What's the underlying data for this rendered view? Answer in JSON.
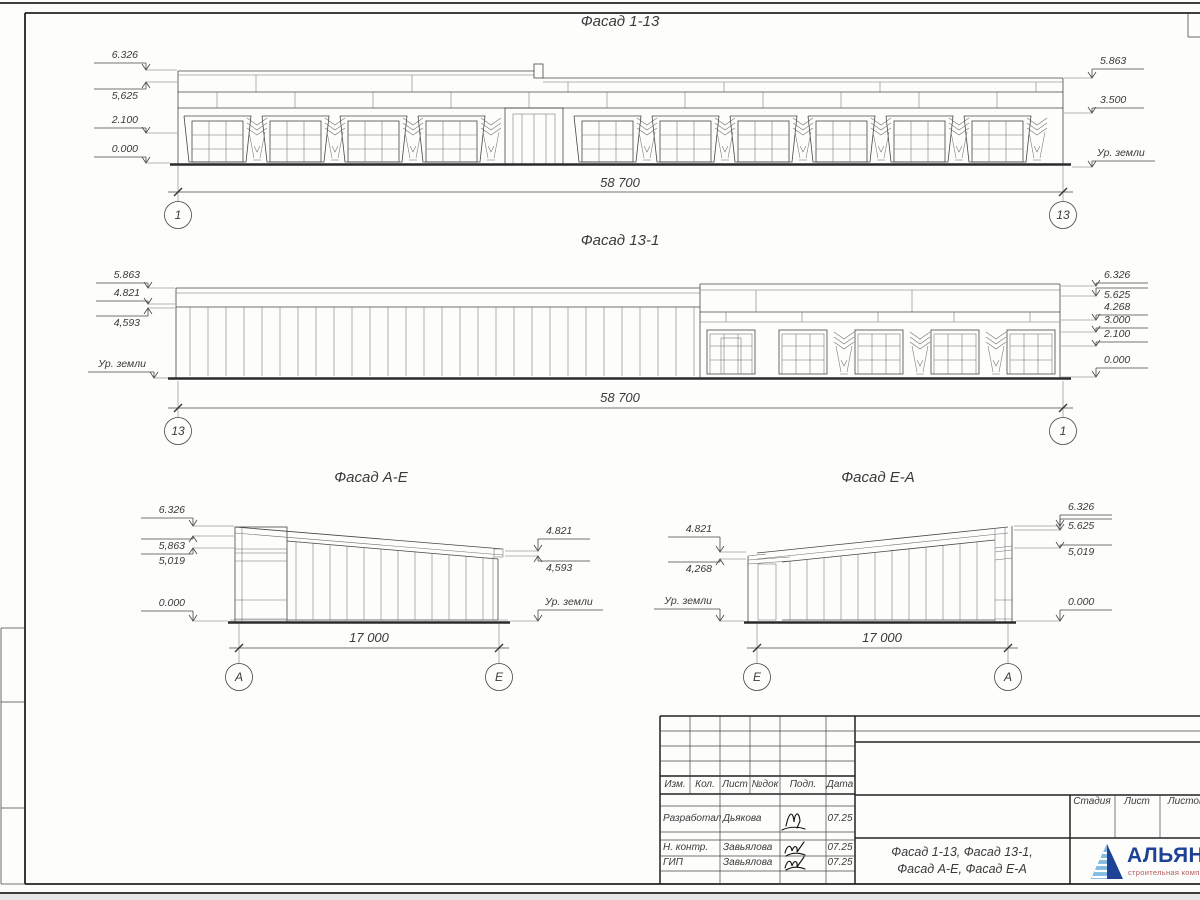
{
  "elevations": {
    "f113": {
      "title": "Фасад 1-13",
      "dim": "58 700",
      "axis_left": "1",
      "axis_right": "13",
      "levels_left": [
        "6.326",
        "5,625",
        "2.100",
        "0.000"
      ],
      "levels_right": [
        "5.863",
        "3.500",
        "Ур. земли"
      ]
    },
    "f131": {
      "title": "Фасад 13-1",
      "dim": "58 700",
      "axis_left": "13",
      "axis_right": "1",
      "levels_left": [
        "5.863",
        "4.821",
        "4,593",
        "Ур. земли"
      ],
      "levels_right": [
        "6.326",
        "5.625",
        "4.268",
        "3.000",
        "2.100",
        "0.000"
      ]
    },
    "fae": {
      "title": "Фасад А-Е",
      "dim": "17 000",
      "axis_left": "А",
      "axis_right": "Е",
      "levels_left": [
        "6.326",
        "5,863",
        "5,019",
        "0.000"
      ],
      "levels_right": [
        "4.821",
        "4,593",
        "Ур. земли"
      ]
    },
    "fea": {
      "title": "Фасад Е-А",
      "dim": "17 000",
      "axis_left": "Е",
      "axis_right": "А",
      "levels_left": [
        "4.821",
        "4,268",
        "Ур. земли"
      ],
      "levels_right": [
        "6.326",
        "5.625",
        "5,019",
        "0.000"
      ]
    }
  },
  "titleblock": {
    "columns": [
      "Изм.",
      "Кол.",
      "Лист",
      "№док",
      "Подп.",
      "Дата"
    ],
    "rows": [
      {
        "role": "Разработал",
        "name": "Дьякова",
        "date": "07.25"
      },
      {
        "role": "Н. контр.",
        "name": "Завьялова",
        "date": "07.25"
      },
      {
        "role": "ГИП",
        "name": "Завьялова",
        "date": "07.25"
      }
    ],
    "doc_title_line1": "Фасад 1-13, Фасад 13-1,",
    "doc_title_line2": "Фасад А-Е, Фасад Е-А",
    "stage_cols": [
      "Стадия",
      "Лист",
      "Листов"
    ],
    "logo": {
      "name": "АЛЬЯНС",
      "subtitle": "строительная компания",
      "icon": "stepped-pyramid-icon",
      "brand_color": "#1e4296",
      "subtitle_color": "#b4595a"
    },
    "signature_icon": "signature-scribble"
  }
}
